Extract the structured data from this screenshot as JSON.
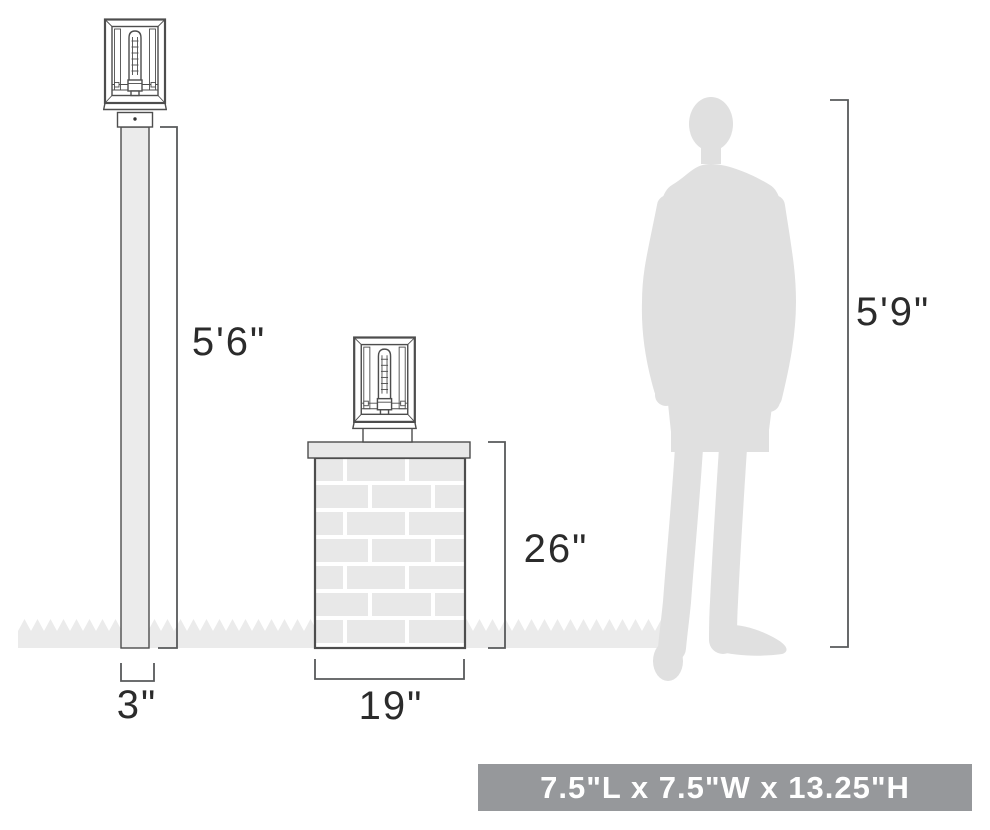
{
  "dimension_labels": {
    "post_height": "5'6\"",
    "pier_height": "26\"",
    "person_height": "5'9\"",
    "post_width": "3\"",
    "pier_width": "19\""
  },
  "banner": {
    "text": "7.5\"L x 7.5\"W x 13.25\"H"
  },
  "colors": {
    "banner_bg": "#96989b",
    "banner_text": "#ffffff",
    "outline": "#4d4d4d",
    "dimension_line": "#58595b",
    "label_text": "#2b2b2b",
    "light_fill": "#ebebeb",
    "brick_fill": "#e8e8e8",
    "mortar_fill": "#ffffff",
    "silhouette_fill": "#e0e0e0"
  },
  "icons": {
    "lantern": "lantern-fixture-icon",
    "person": "person-silhouette-icon",
    "grass": "grass-zigzag-icon",
    "brick_pier": "brick-pier-icon",
    "lamp_post": "lamp-post-icon"
  }
}
